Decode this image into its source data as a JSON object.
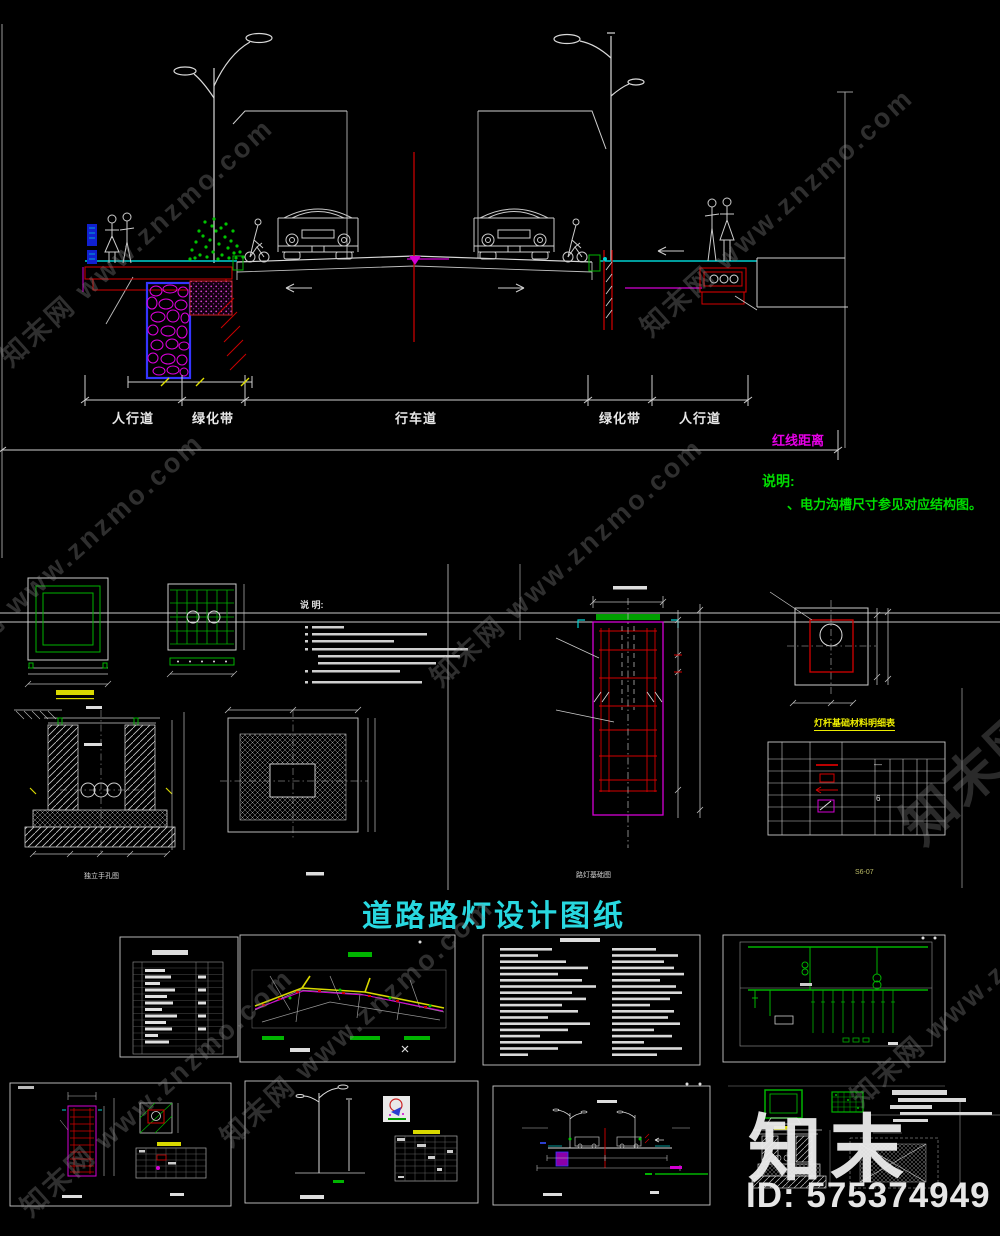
{
  "watermark": {
    "text": "知末网 www.znzmo.com"
  },
  "brand": {
    "logo_text": "知末",
    "id_text": "ID: 575374949"
  },
  "cross_section": {
    "zone_labels": [
      "人行道",
      "绿化带",
      "行车道",
      "绿化带",
      "人行道"
    ],
    "red_line_label": "红线距离",
    "notes_title": "说明:",
    "note_1": "、电力沟槽尺寸参见对应结构图。"
  },
  "details": {
    "notes_title": "说 明:",
    "table_title": "灯杆基础材料明细表",
    "caption_handhole": "独立手孔图",
    "caption_foundation": "路灯基础图",
    "sheet_no": "S6-07",
    "table_dash": "—",
    "table_qty": "6"
  },
  "title_block": {
    "title": "道路路灯设计图纸"
  }
}
